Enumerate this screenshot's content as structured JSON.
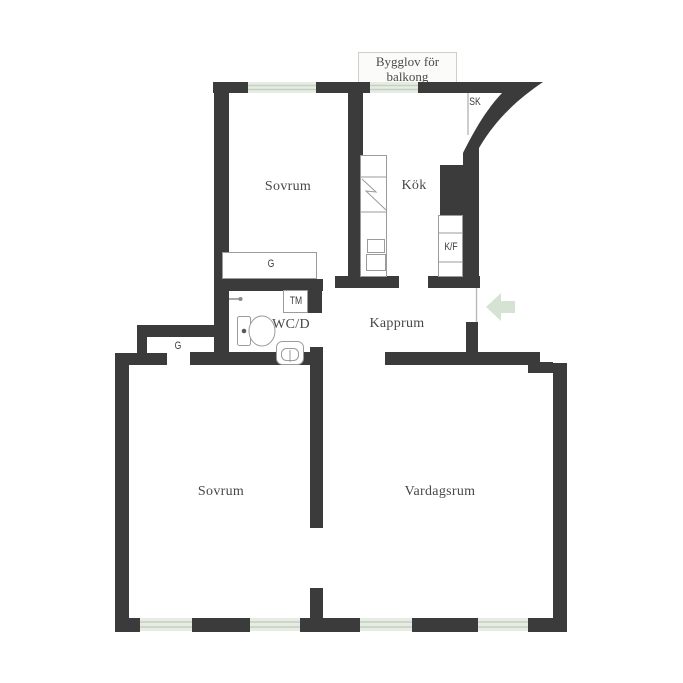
{
  "colors": {
    "wall": "#3b3b3b",
    "window": "#e6ece3",
    "window_line": "#c3d0c2",
    "arrow": "#d6e2d4",
    "fixture_line": "#9b9b9b",
    "label": "#474747"
  },
  "plan": {
    "permit_note": {
      "line1": "Bygglov för",
      "line2": "balkong"
    },
    "rooms": [
      {
        "id": "sovrum-top",
        "label": "Sovrum"
      },
      {
        "id": "kok",
        "label": "Kök"
      },
      {
        "id": "kapprum",
        "label": "Kapprum"
      },
      {
        "id": "wcd",
        "label": "WC/D"
      },
      {
        "id": "sovrum-bottom",
        "label": "Sovrum"
      },
      {
        "id": "vardagsrum",
        "label": "Vardagsrum"
      }
    ],
    "fixtures": [
      {
        "id": "sk",
        "label": "SK"
      },
      {
        "id": "kf",
        "label": "K/F"
      },
      {
        "id": "tm",
        "label": "TM"
      },
      {
        "id": "g-top",
        "label": "G"
      },
      {
        "id": "g-bottom",
        "label": "G"
      }
    ],
    "entrance_arrow_direction": "left"
  }
}
